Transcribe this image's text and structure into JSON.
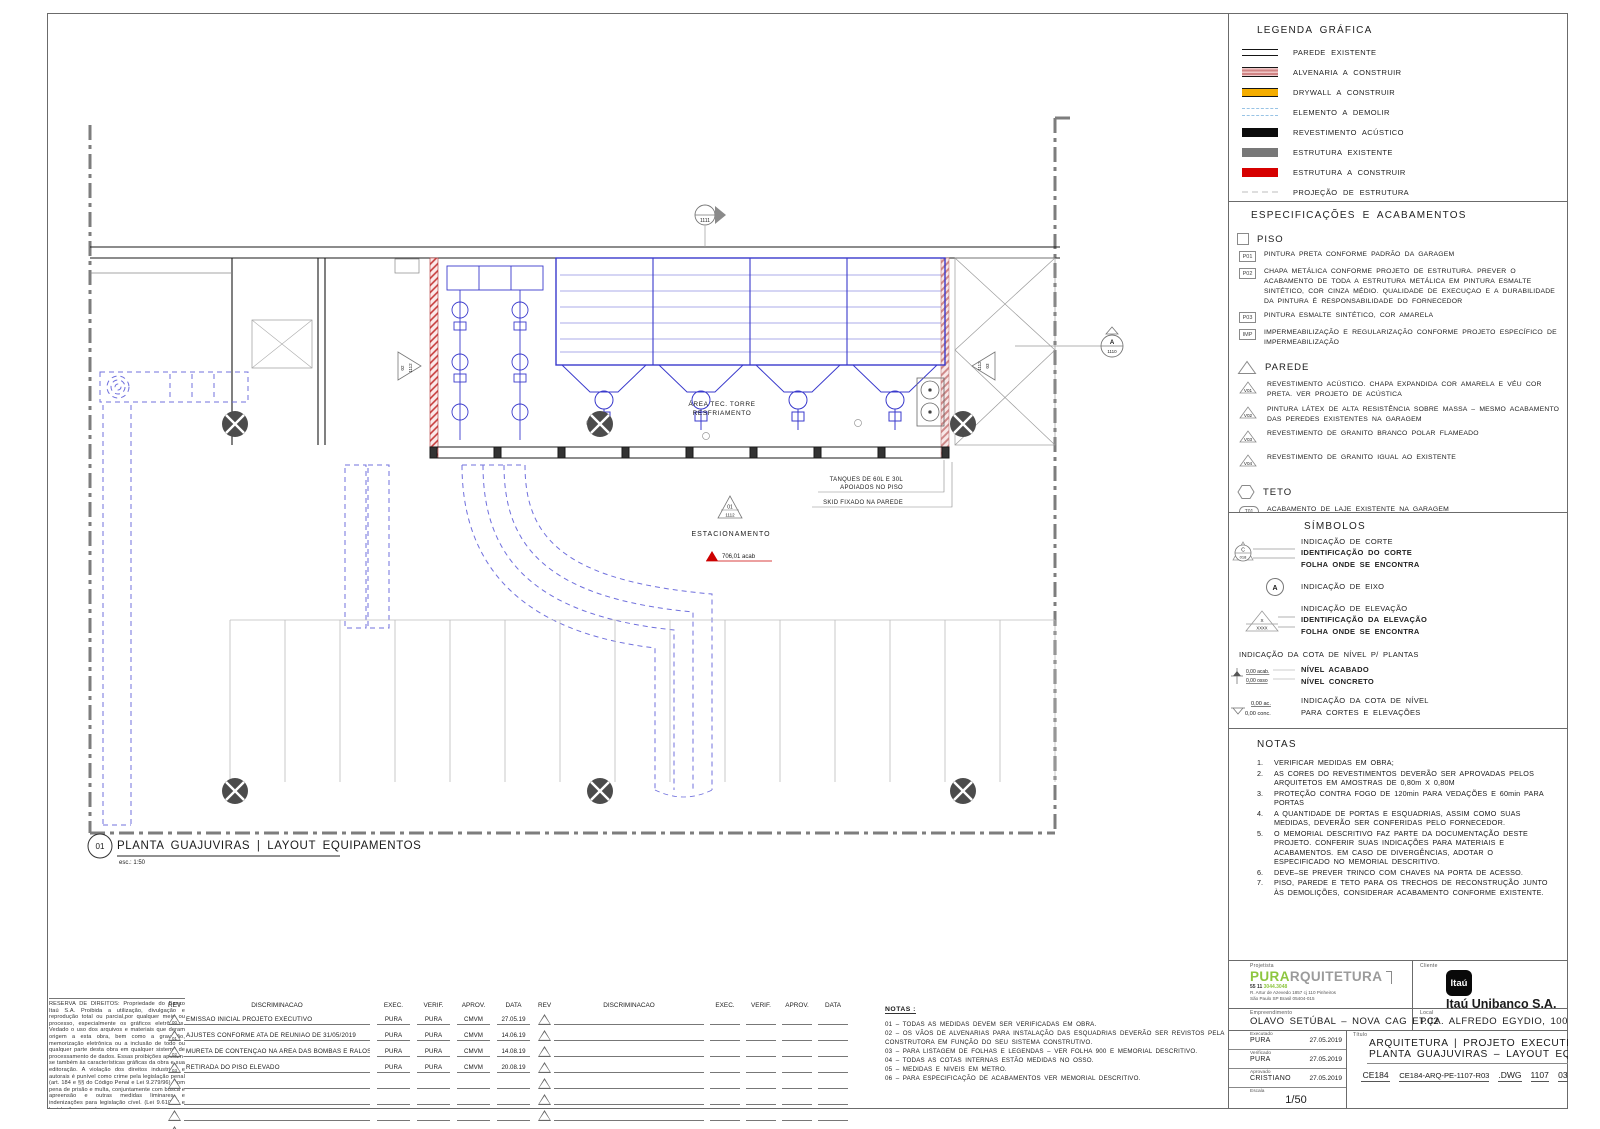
{
  "legend": {
    "title": "LEGENDA GRÁFICA",
    "items": [
      {
        "type": "existing-wall-swatch",
        "label": "PAREDE EXISTENTE"
      },
      {
        "type": "masonry-swatch",
        "label": "ALVENARIA A CONSTRUIR"
      },
      {
        "type": "drywall-swatch",
        "label": "DRYWALL A CONSTRUIR"
      },
      {
        "type": "demolish-swatch",
        "label": "ELEMENTO A DEMOLIR"
      },
      {
        "type": "acoustic-swatch",
        "label": "REVESTIMENTO ACÚSTICO"
      },
      {
        "type": "structure-existing-swatch",
        "label": "ESTRUTURA EXISTENTE"
      },
      {
        "type": "structure-new-swatch",
        "label": "ESTRUTURA A CONSTRUIR"
      },
      {
        "type": "structure-projection-swatch",
        "label": "PROJEÇÃO DE ESTRUTURA"
      }
    ]
  },
  "specs": {
    "title": "ESPECIFICAÇÕES E ACABAMENTOS",
    "piso_label": "PISO",
    "piso": [
      {
        "tag": "P01",
        "text": "PINTURA PRETA CONFORME PADRÃO DA GARAGEM"
      },
      {
        "tag": "P02",
        "text": "CHAPA METÁLICA CONFORME PROJETO DE ESTRUTURA. PREVER O ACABAMENTO DE TODA A ESTRUTURA METÁLICA EM PINTURA ESMALTE SINTÉTICO, COR CINZA MÉDIO. QUALIDADE DE EXECUÇAO E A DURABILIDADE DA PINTURA É RESPONSABILIDADE DO FORNECEDOR"
      },
      {
        "tag": "P03",
        "text": "PINTURA ESMALTE SINTÉTICO, COR AMARELA"
      },
      {
        "tag": "IMP",
        "text": "IMPERMEABILIZAÇÃO E REGULARIZAÇÃO CONFORME PROJETO ESPECÍFICO DE IMPERMEABILIZAÇÃO"
      }
    ],
    "parede_label": "PAREDE",
    "parede": [
      {
        "tag": "V01",
        "text": "REVESTIMENTO ACÚSTICO. CHAPA EXPANDIDA COR AMARELA E VÉU COR PRETA. VER PROJETO DE ACÚSTICA"
      },
      {
        "tag": "V02",
        "text": "PINTURA LÁTEX DE ALTA RESISTÊNCIA SOBRE MASSA – MESMO ACABAMENTO DAS PEREDES EXISTENTES NA GARAGEM"
      },
      {
        "tag": "V03",
        "text": "REVESTIMENTO DE GRANITO BRANCO POLAR FLAMEADO"
      },
      {
        "tag": "V04",
        "text": "REVESTIMENTO DE GRANITO IGUAL AO EXISTENTE"
      }
    ],
    "teto_label": "TETO",
    "teto": [
      {
        "tag": "T01",
        "text": "ACABAMENTO DE LAJE EXISTENTE NA GARAGEM"
      },
      {
        "tag": "T02",
        "text": "LAMELAS ACÚSTICAS"
      }
    ]
  },
  "symbols": {
    "title": "SÍMBOLOS",
    "corte": {
      "l1": "INDICAÇÃO DE CORTE",
      "l2": "IDENTIFICAÇÃO DO CORTE",
      "l3": "FOLHA ONDE SE ENCONTRA",
      "letter": "C",
      "num": "018"
    },
    "eixo": {
      "label": "INDICAÇÃO DE EIXO",
      "letter": "A"
    },
    "elev": {
      "l1": "INDICAÇÃO DE ELEVAÇÃO",
      "l2": "IDENTIFICAÇÃO DA ELEVAÇÃO",
      "l3": "FOLHA ONDE SE ENCONTRA",
      "letter": "X",
      "num": "XXXX"
    },
    "cota_plantas": {
      "title": "INDICAÇÃO DA COTA DE NÍVEL P/ PLANTAS",
      "l1": "NÍVEL ACABADO",
      "l2": "NÍVEL CONCRETO",
      "g1": "0,00 acab.",
      "g2": "0,00 osso"
    },
    "cota_cortes": {
      "l1": "INDICAÇÃO DA COTA DE NÍVEL",
      "l2": "PARA CORTES E ELEVAÇÕES",
      "g1": "0,00 ac.",
      "g2": "0,00 conc."
    },
    "desnivel": {
      "label": "INDICAÇÃO DE DESNÍVEL"
    }
  },
  "notes_right": {
    "title": "NOTAS",
    "items": [
      {
        "n": "1.",
        "t": "VERIFICAR MEDIDAS EM OBRA;"
      },
      {
        "n": "2.",
        "t": "AS CORES DO REVESTIMENTOS DEVERÃO SER APROVADAS PELOS ARQUITETOS EM AMOSTRAS DE 0,80m X 0,80M"
      },
      {
        "n": "3.",
        "t": "PROTEÇÃO CONTRA FOGO DE 120min PARA VEDAÇÕES E 60min PARA PORTAS"
      },
      {
        "n": "4.",
        "t": "A QUANTIDADE DE PORTAS E ESQUADRIAS, ASSIM COMO SUAS MEDIDAS, DEVERÃO SER CONFERIDAS PELO FORNECEDOR."
      },
      {
        "n": "5.",
        "t": "O MEMORIAL DESCRITIVO FAZ PARTE DA DOCUMENTAÇÃO DESTE PROJETO. CONFERIR SUAS INDICAÇÕES PARA MATERIAIS E ACABAMENTOS. EM CASO DE DIVERGÊNCIAS, ADOTAR O ESPECIFICADO NO MEMORIAL DESCRITIVO."
      },
      {
        "n": "6.",
        "t": "DEVE–SE PREVER TRINCO COM CHAVES NA PORTA DE ACESSO."
      },
      {
        "n": "7.",
        "t": "PISO, PAREDE E TETO PARA OS TRECHOS DE RECONSTRUÇÃO JUNTO ÀS DEMOLIÇÕES, CONSIDERAR ACABAMENTO CONFORME EXISTENTE."
      }
    ]
  },
  "plan": {
    "area_label_1": "ÁREA TEC. TORRE",
    "area_label_2": "RESFRIAMENTO",
    "parking_label": "ESTACIONAMENTO",
    "level_label": "706,01 acab",
    "callout1a": "TANQUES DE 60L E 30L",
    "callout1b": "APOIADOS NO PISO",
    "callout2": "SKID FIXADO NA PAREDE",
    "marker_top_num": "1111",
    "marker_right_letter": "A",
    "marker_right_num": "1110",
    "marker_left_letter": "02",
    "marker_left_num": "1112",
    "marker_r2_letter": "03",
    "marker_r2_num": "1112",
    "marker_plan_letter": "01",
    "marker_plan_num": "1112",
    "title_num": "01",
    "title": "PLANTA GUAJUVIRAS | LAYOUT EQUIPAMENTOS",
    "scale": "esc.: 1:50"
  },
  "rev_table": {
    "headers": {
      "rev": "REV",
      "disc": "DISCRIMINACAO",
      "exec": "EXEC.",
      "verif": "VERIF.",
      "aprov": "APROV.",
      "data": "DATA"
    },
    "rows": [
      {
        "rev": "00",
        "disc": "EMISSÃO INICIAL PROJETO EXECUTIVO",
        "exec": "PURA",
        "verif": "PURA",
        "aprov": "CMVM",
        "data": "27.05.19"
      },
      {
        "rev": "01",
        "disc": "AJUSTES CONFORME ATA DE REUNIÃO DE 31/05/2019",
        "exec": "PURA",
        "verif": "PURA",
        "aprov": "CMVM",
        "data": "14.06.19"
      },
      {
        "rev": "02",
        "disc": "MURETA DE CONTENÇÃO NA ÁREA DAS BOMBAS E RALOS",
        "exec": "PURA",
        "verif": "PURA",
        "aprov": "CMVM",
        "data": "14.08.19"
      },
      {
        "rev": "03",
        "disc": "RETIRADA DO PISO ELEVADO",
        "exec": "PURA",
        "verif": "PURA",
        "aprov": "CMVM",
        "data": "20.08.19"
      }
    ]
  },
  "notes_bottom": {
    "title": "NOTAS :",
    "items": [
      "01 – TODAS AS MEDIDAS DEVEM SER VERIFICADAS EM OBRA.",
      "02 – OS VÃOS DE ALVENARIAS PARA INSTALAÇÃO DAS ESQUADRIAS DEVERÃO SER REVISTOS PELA CONSTRUTORA EM FUNÇÃO DO SEU SISTEMA CONSTRUTIVO.",
      "03 – PARA LISTAGEM DE FOLHAS E LEGENDAS  – VER FOLHA 900 E MEMORIAL DESCRITIVO.",
      "04 – TODAS AS COTAS INTERNAS ESTÃO MEDIDAS NO OSSO.",
      "05 – MEDIDAS E NIVEIS EM METRO.",
      "06 – PARA ESPECIFICAÇÃO DE ACABAMENTOS VER MEMORIAL DESCRITIVO."
    ]
  },
  "titleblock": {
    "projetista_label": "Projetista",
    "firm_bold": "PURA",
    "firm_rest": "RQUITETURA",
    "firm_phone_pre": "55 11 ",
    "firm_phone_green": "3044.3048",
    "firm_addr1": "R. Artur de Azevedo 1857 cj 110 Pinheiros",
    "firm_addr2": "São Paulo SP Brasil 05404-015",
    "cliente_label": "Cliente",
    "client_logo": "Itaú",
    "client_name": "Itaú Unibanco S.A.",
    "empreendimento_label": "Empreendimento",
    "empreendimento": "OLAVO SETÚBAL – NOVA CAG ET.02",
    "local_label": "Local",
    "local": "PÇA. ALFREDO EGYDIO, 100",
    "executado_label": "Executado",
    "executado": "PURA",
    "executado_data": "27.05.2019",
    "verificado_label": "Verificado",
    "verificado": "PURA",
    "verificado_data": "27.05.2019",
    "aprovado_label": "Aprovado",
    "aprovado": "CRISTIANO",
    "aprovado_data": "27.05.2019",
    "escala_label": "Escala",
    "escala": "1/50",
    "titulo_label": "Título",
    "titulo1": "ARQUITETURA | PROJETO EXECUTIVO",
    "titulo2": "PLANTA GUAJUVIRAS – LAYOUT EQUIPAMENTO",
    "code1": "CE184",
    "code2": "CE184-ARQ-PE-1107-R03",
    "code3": ".DWG",
    "code4": "1107",
    "code5": "03"
  },
  "copyright": "RESERVA DE DIREITOS: Propriedade do Banco Itaú S.A. Proibida a utilização, divulgação e reprodução total ou parcial,por qualquer meio ou processo,  especialmente os gráficos eletrônicos. Vedado o uso dos arquivos e materiais que deram origem  a esta obra, bem como a gravação, memorização eletrônica ou a inclusão de todo ou qualquer parte desta  obra em qualquer sistema de processamento de  dados. Essas proibições aplicam-se  também  às  características  gráficas  da obra e sua editoração. A violação dos direitos industriais e autorais é punível como crime pela legislação penal (art. 184 e §§ do Código Penal  e Lei 9.279/96), com pena de  prisão e  multa,  conjuntamente com busca e apreensão e outras medidas liminares e indenizações para legislação cível. (Lei 9.610/98 e legislação conexa)",
  "colors": {
    "accent_green": "#8dc63f",
    "masonry_pink": "#d08484",
    "drywall_amber": "#f4ad00",
    "demolish_blue": "#98c3e5",
    "structure_gray": "#787878",
    "structure_red": "#d60000",
    "equipment_blue": "#3a3acc",
    "level_red": "#cc0000"
  }
}
